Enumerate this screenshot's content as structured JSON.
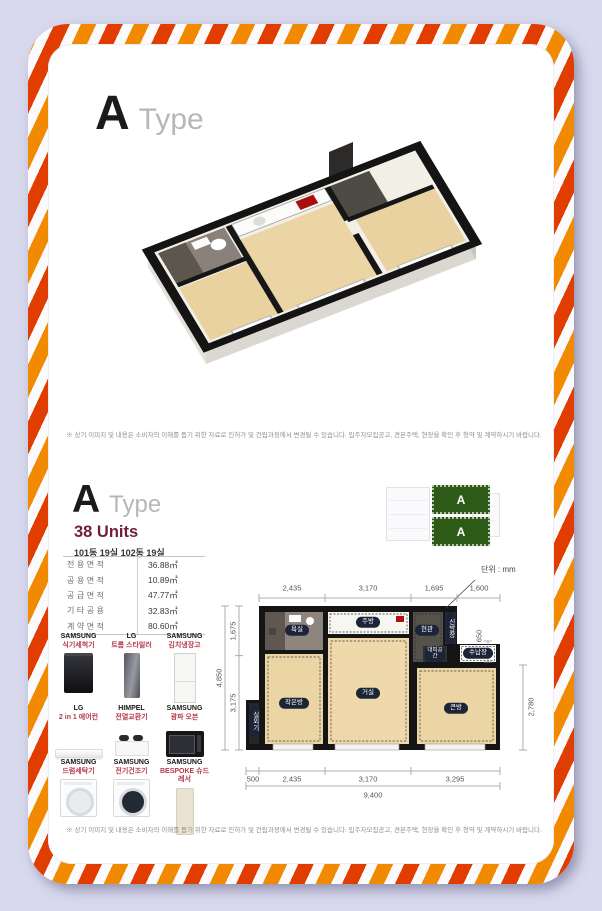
{
  "header": {
    "letter": "A",
    "word": "Type"
  },
  "top_disclaimer": "※ 상기 이미지 및 내용은 소비자의 이해를 돕기 위한 자료로 인허가 및 건립과정에서 변경될 수 있습니다. 입주자모집공고, 견본주택, 현장을 확인 후 청약 및 계약하시기 바랍니다.",
  "lower": {
    "letter": "A",
    "word": "Type",
    "units": "38 Units",
    "units_detail": "101동 19실  102동 19실"
  },
  "area_table": {
    "rows": [
      {
        "label": "전용면적",
        "value": "36.88㎡"
      },
      {
        "label": "공용면적",
        "value": "10.89㎡"
      },
      {
        "label": "공급면적",
        "value": "47.77㎡"
      },
      {
        "label": "기타공용",
        "value": "32.83㎡"
      },
      {
        "label": "계약면적",
        "value": "80.60㎡"
      }
    ]
  },
  "appliances": [
    {
      "brand": "SAMSUNG",
      "name": "식기세척기",
      "icon": "dishwasher-icon"
    },
    {
      "brand": "LG",
      "name": "트롬 스타일러",
      "icon": "styler-icon"
    },
    {
      "brand": "SAMSUNG",
      "name": "김치냉장고",
      "icon": "kimchi-fridge-icon"
    },
    {
      "brand": "LG",
      "name": "2 in 1 에어컨",
      "icon": "air-conditioner-icon"
    },
    {
      "brand": "HIMPEL",
      "name": "전열교환기",
      "icon": "ventilator-icon"
    },
    {
      "brand": "SAMSUNG",
      "name": "광파 오븐",
      "icon": "oven-icon"
    },
    {
      "brand": "SAMSUNG",
      "name": "드럼세탁기",
      "icon": "washer-icon"
    },
    {
      "brand": "SAMSUNG",
      "name": "전기건조기",
      "icon": "dryer-icon"
    },
    {
      "brand": "SAMSUNG",
      "name": "BESPOKE 슈드레서",
      "icon": "shoe-dresser-icon"
    }
  ],
  "plan": {
    "unit_note": "단위 : mm",
    "rooms": {
      "bath": "욕실",
      "kitchen": "주방",
      "entry": "현관",
      "shoe": "신발장",
      "shelter": "대피공간",
      "storage": "수납장",
      "small_room": "작은방",
      "living": "거실",
      "big_room": "큰방",
      "outdoor_unit": "실외기"
    },
    "dims": {
      "top": [
        "2,435",
        "3,170",
        "1,695",
        "1,600"
      ],
      "bottom": [
        "500",
        "2,435",
        "3,170",
        "3,295"
      ],
      "bottom_total": "9,400",
      "left": [
        "1,675",
        "3,175"
      ],
      "left_total": "4,850",
      "right": [
        "650",
        "2,780"
      ]
    }
  },
  "sitemap": {
    "block": "A"
  },
  "bottom_disclaimer": "※ 상기 이미지 및 내용은 소비자의 이해를 돕기 위한 자료로 인허가 및 건립과정에서 변경될 수 있습니다. 입주자모집공고, 견본주택, 현장을 확인 후 청약 및 계약하시기 바랍니다.",
  "colors": {
    "stripe_orange": "#f18a00",
    "stripe_red": "#e23d00",
    "accent_maroon": "#6f1f3c",
    "product_red": "#b5394b",
    "pill_navy": "#1c2437",
    "site_green": "#2d5a16",
    "wood_floor": "#ecd5a5"
  }
}
